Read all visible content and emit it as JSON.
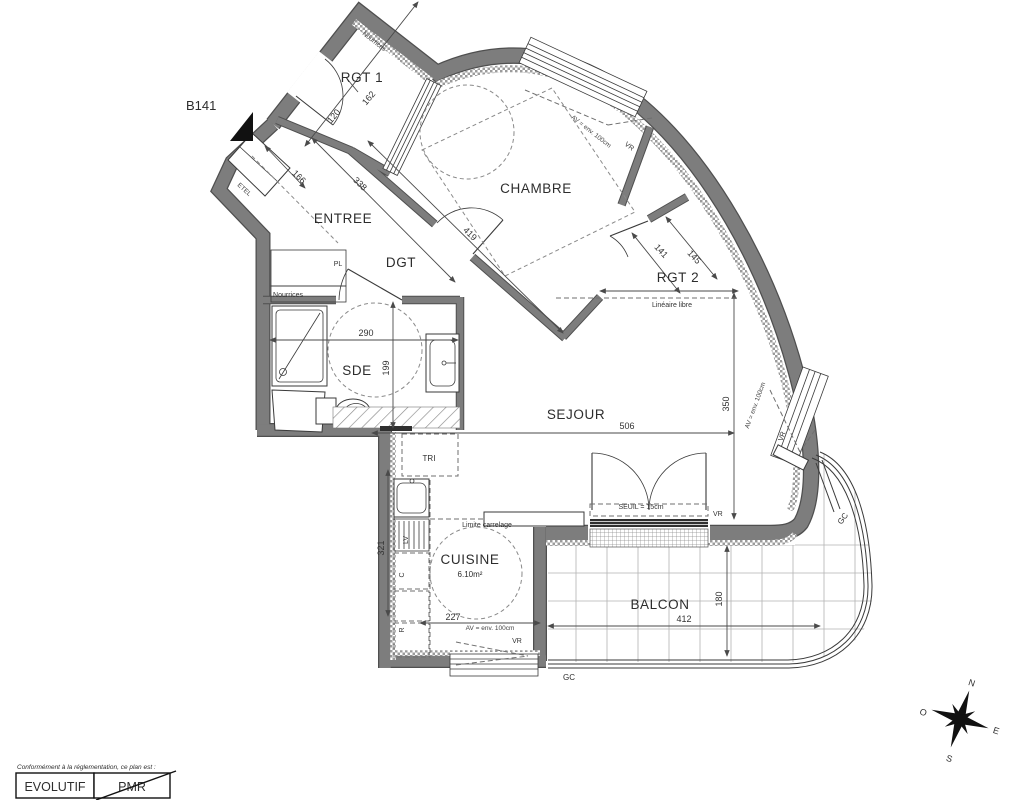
{
  "title": "B141",
  "rooms": {
    "rgt1": "RGT 1",
    "chambre": "CHAMBRE",
    "entree": "ENTREE",
    "dgt": "DGT",
    "rgt2": "RGT 2",
    "sde": "SDE",
    "sejour": "SEJOUR",
    "cuisine": "CUISINE",
    "cuisine_area": "6.10m²",
    "balcon": "BALCON"
  },
  "dims": {
    "rgt1_a": "120",
    "rgt1_b": "162",
    "entree_a": "166",
    "entree_b": "338",
    "chambre": "419",
    "rgt2_a": "141",
    "rgt2_b": "145",
    "sde_w": "290",
    "sde_d": "199",
    "sejour_w": "506",
    "sejour_d": "350",
    "cuisine_w": "227",
    "cuisine_d": "321",
    "balcon_w": "412",
    "balcon_d": "180"
  },
  "annotations": {
    "nourrices": "Nourrices",
    "etel": "ETEL",
    "pl": "PL",
    "tri": "TRI",
    "lv": "LV",
    "c": "C",
    "r": "R",
    "lineaire_libre": "Linéaire libre",
    "limite_carrelage": "Limite carrelage",
    "seuil": "SEUIL = 15cm",
    "av": "AV = env. 100cm",
    "vr": "VR",
    "gc": "GC"
  },
  "legend": {
    "intro": "Conformément à la réglementation, ce plan est :",
    "evolutif": "EVOLUTIF",
    "pmr": "PMR"
  },
  "compass": {
    "n": "N",
    "e": "E",
    "s": "S",
    "o": "O"
  },
  "colors": {
    "wall": "#7d7d7d",
    "line": "#3a3a3a",
    "background": "#ffffff"
  }
}
